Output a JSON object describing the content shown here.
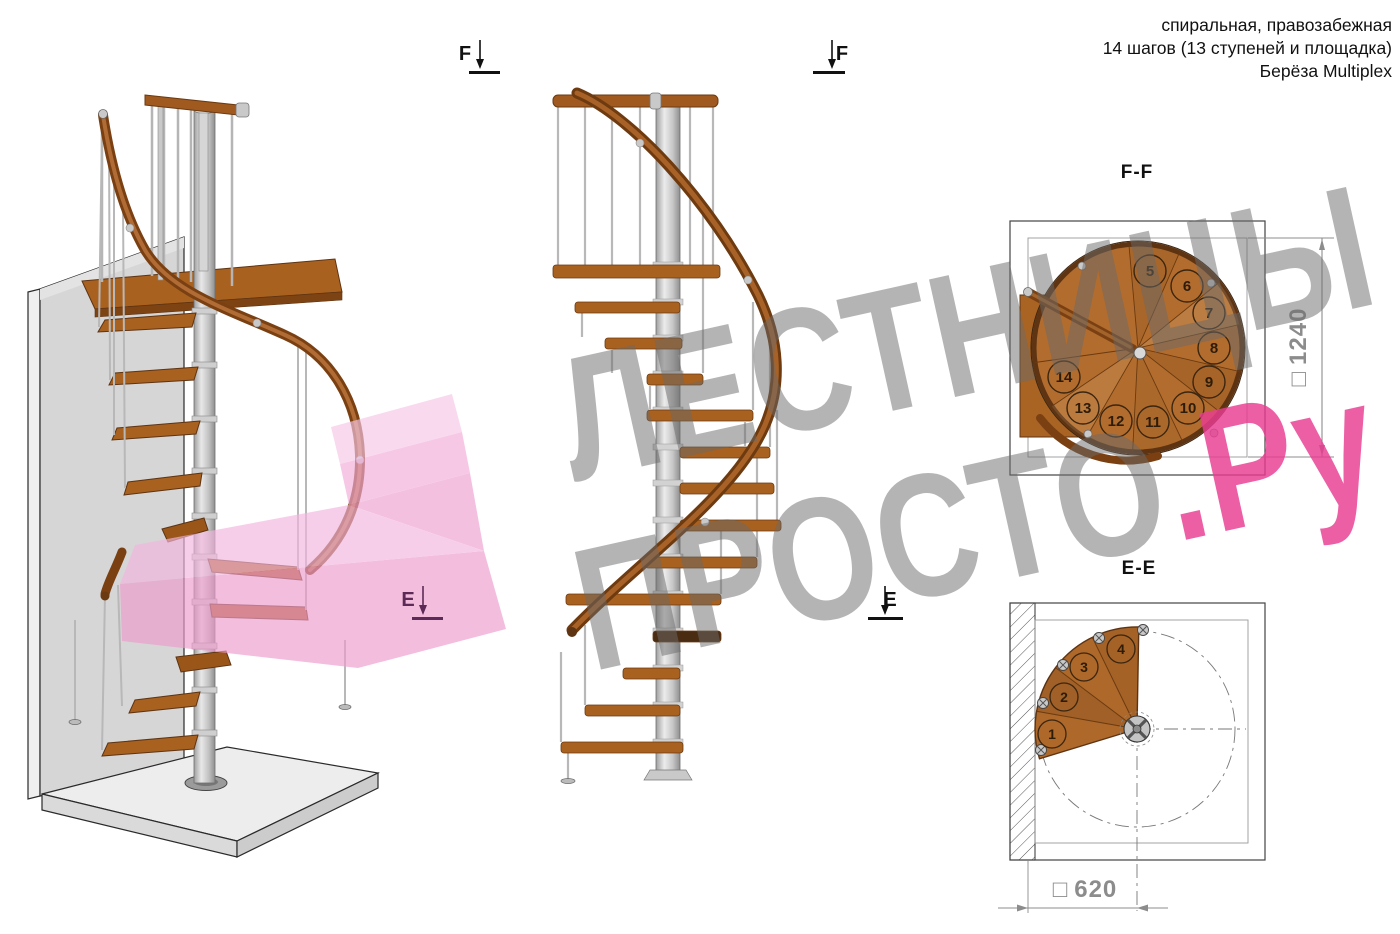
{
  "annotation": {
    "line1": "спиральная, правозабежная",
    "line2": "14 шагов (13 ступеней и площадка)",
    "line3": "Берёза Multiplex"
  },
  "section_markers": {
    "f_left": "F",
    "f_right": "F",
    "e_left": "E",
    "e_right": "E"
  },
  "views": {
    "ff": {
      "title": "F-F",
      "steps": [
        "5",
        "6",
        "7",
        "8",
        "9",
        "10",
        "11",
        "12",
        "13",
        "14"
      ],
      "dimension": {
        "symbol": "□",
        "value": "1240"
      }
    },
    "ee": {
      "title": "E-E",
      "steps": [
        "1",
        "2",
        "3",
        "4"
      ],
      "dimension": {
        "symbol": "□",
        "value": "620"
      }
    }
  },
  "watermark": {
    "line1": "ЛЕСТНИЦЫ",
    "line2_gray": "ПРОСТО",
    "line2_pink": ".Ру"
  },
  "colors": {
    "wood": "#a9611f",
    "wood_dark": "#5e3413",
    "metal": "#c9c9c9",
    "accent_pink": "#e93c91",
    "watermark_gray": "#9b9b9b",
    "dimension_gray": "#8c8c8c"
  }
}
